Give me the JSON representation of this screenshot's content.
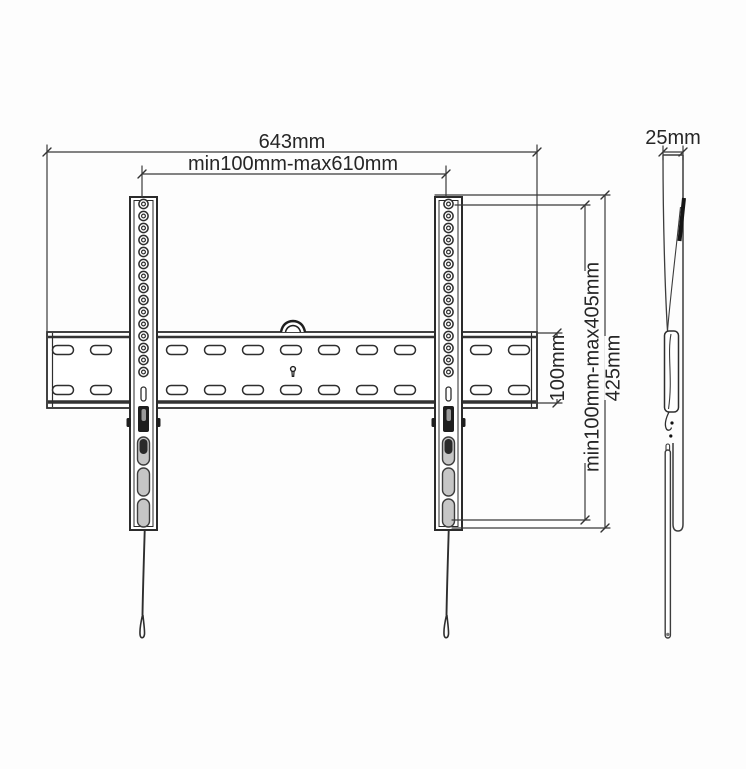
{
  "drawing": {
    "title": "tv-wall-mount-technical-drawing",
    "colors": {
      "background": "#fdfdfd",
      "line": "#2e2e2e",
      "dim_line": "#3a3a3a",
      "text": "#262626",
      "slot_fill": "#c6c6c6",
      "latch_fill": "#1e1e1e"
    },
    "dimensions": {
      "total_width": {
        "label": "643mm"
      },
      "hole_range_horizontal": {
        "label": "min100mm-max610mm"
      },
      "rail_height": {
        "label": "100mm"
      },
      "hole_range_vertical": {
        "label": "min100mm-max405mm"
      },
      "bracket_height": {
        "label": "425mm"
      },
      "depth": {
        "label": "25mm"
      }
    },
    "views": {
      "front": "front-view",
      "side": "side-view"
    }
  }
}
